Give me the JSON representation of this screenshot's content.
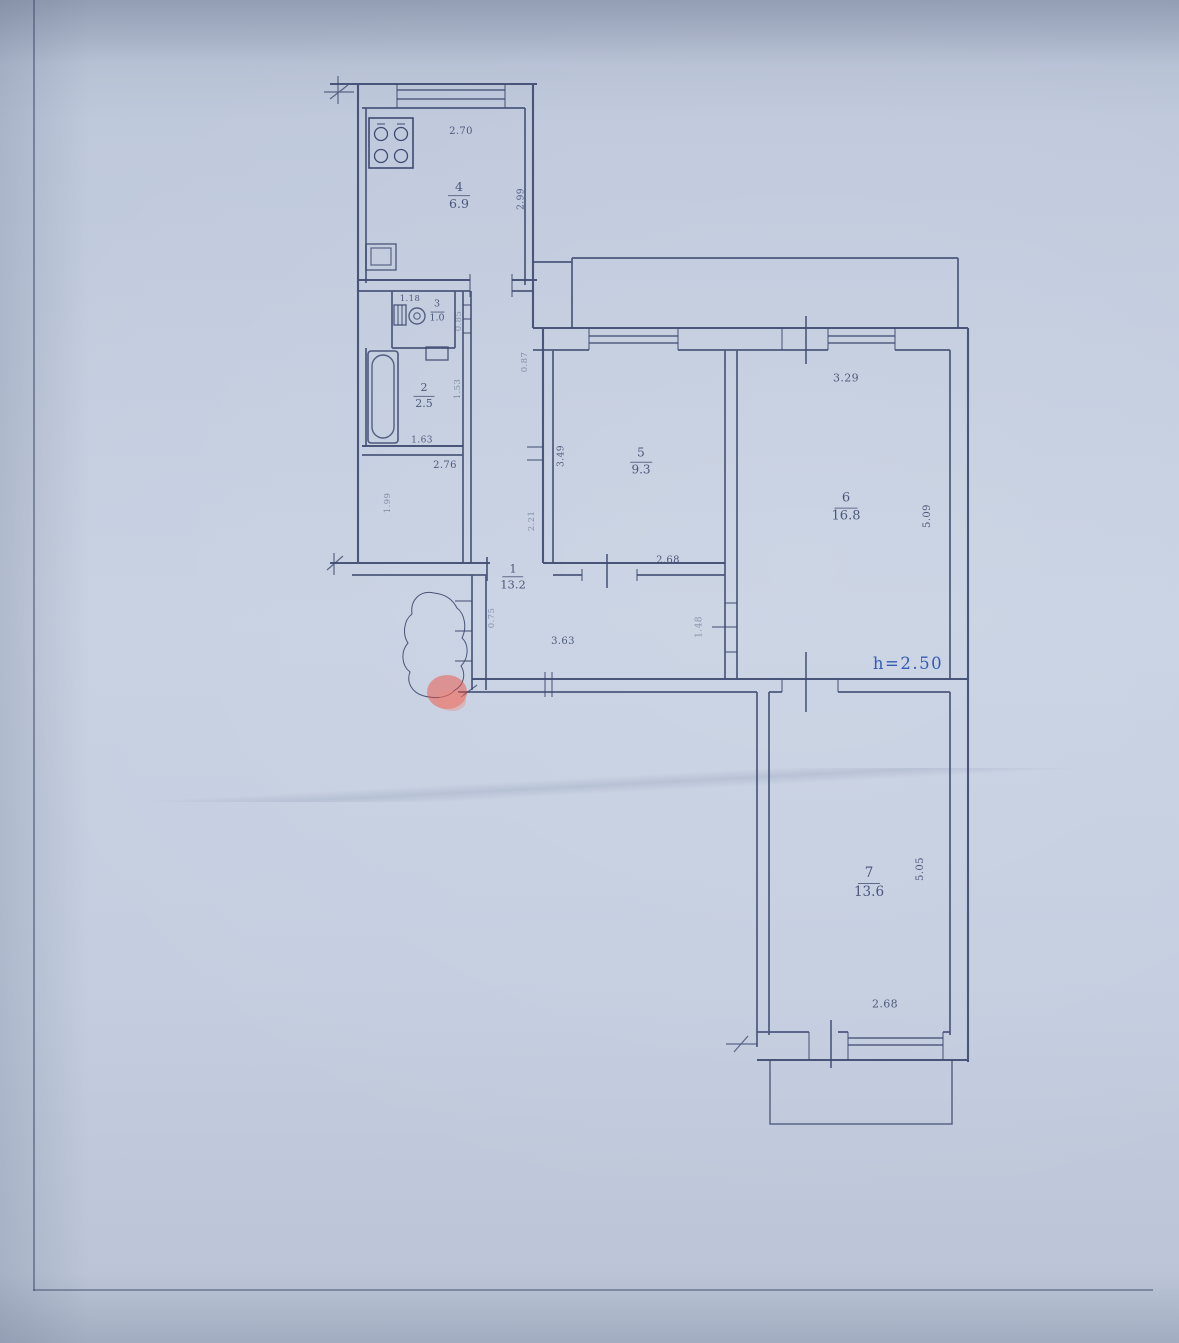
{
  "rooms": {
    "corridor": {
      "number": "1",
      "area": "13.2"
    },
    "bath": {
      "number": "2",
      "area": "2.5"
    },
    "wc": {
      "number": "3",
      "area": "1.0"
    },
    "kitchen": {
      "number": "4",
      "area": "6.9"
    },
    "room5": {
      "number": "5",
      "area": "9.3"
    },
    "living": {
      "number": "6",
      "area": "16.8"
    },
    "bedroom": {
      "number": "7",
      "area": "13.6"
    }
  },
  "dims": {
    "kitchen_top": "2.70",
    "kitchen_right": "2.99",
    "wc_top": "1.18",
    "wc_right": "0.85",
    "bath_right": "1.53",
    "bath_bottom": "1.63",
    "hall_bottom": "2.76",
    "hall_left": "1.99",
    "vestibule": "0.87",
    "corridor_mid": "2.21",
    "room5_left": "3.49",
    "room5_bottom": "2.68",
    "living_top": "3.29",
    "living_right": "5.09",
    "door": "1.48",
    "corridor_bottom": "3.63",
    "entry": "0.75",
    "ceiling": "h=2.50",
    "bedroom_right": "5.05",
    "bedroom_bottom": "2.68"
  },
  "colors": {
    "ink": "#3e4b70",
    "blue_ink": "#5a6cb0",
    "accent_blue": "#2d54b4",
    "marker_red": "#f5432e",
    "paper": "#c3cdde"
  }
}
